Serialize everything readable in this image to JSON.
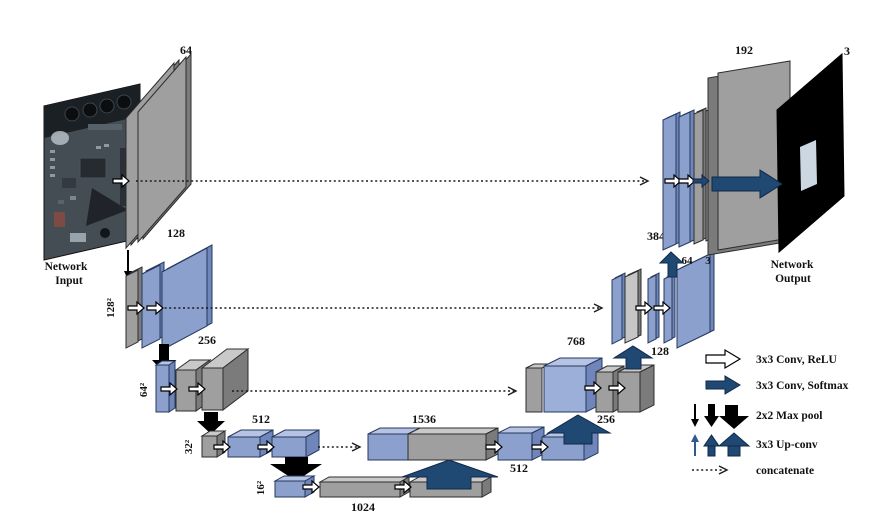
{
  "diagram_title": "U-Net style encoder-decoder network",
  "network_input": {
    "line1": "Network",
    "line2": "Input"
  },
  "network_output": {
    "line1": "Network",
    "line2": "Output",
    "channels": "3"
  },
  "labels": {
    "enc_row1_channels": "64",
    "enc_row2_channels": "128",
    "enc_row2_size": "128²",
    "enc_row3_channels": "256",
    "enc_row3_size": "64²",
    "enc_row4_channels": "512",
    "enc_row4_size": "32²",
    "bottleneck_channels": "1024",
    "bottleneck_size": "16²",
    "dec_row4_concat": "1536",
    "dec_row4_out": "512",
    "dec_row3_up": "256",
    "dec_row3_concat": "768",
    "dec_row2_up": "128",
    "dec_row2_concat": "384",
    "dec_row1_up": "64",
    "dec_row2_out": "3",
    "dec_row1_concat": "192"
  },
  "legend": {
    "items": [
      {
        "icon": "white-right-arrow-icon",
        "label": "3x3 Conv, ReLU"
      },
      {
        "icon": "navy-right-arrow-icon",
        "label": "3x3 Conv, Softmax"
      },
      {
        "icon": "black-down-arrows-icon",
        "label": "2x2 Max pool"
      },
      {
        "icon": "blue-up-arrows-icon",
        "label": "3x3 Up-conv"
      },
      {
        "icon": "dotted-arrow-icon",
        "label": "concatenate"
      }
    ]
  },
  "colors": {
    "blue_block": "#8ca0ce",
    "blue_block_top": "#b7c3e3",
    "gray_block": "#9f9f9f",
    "navy_arrow": "#1f4873",
    "max_pool_arrow": "#000000",
    "output_background": "#000000"
  }
}
